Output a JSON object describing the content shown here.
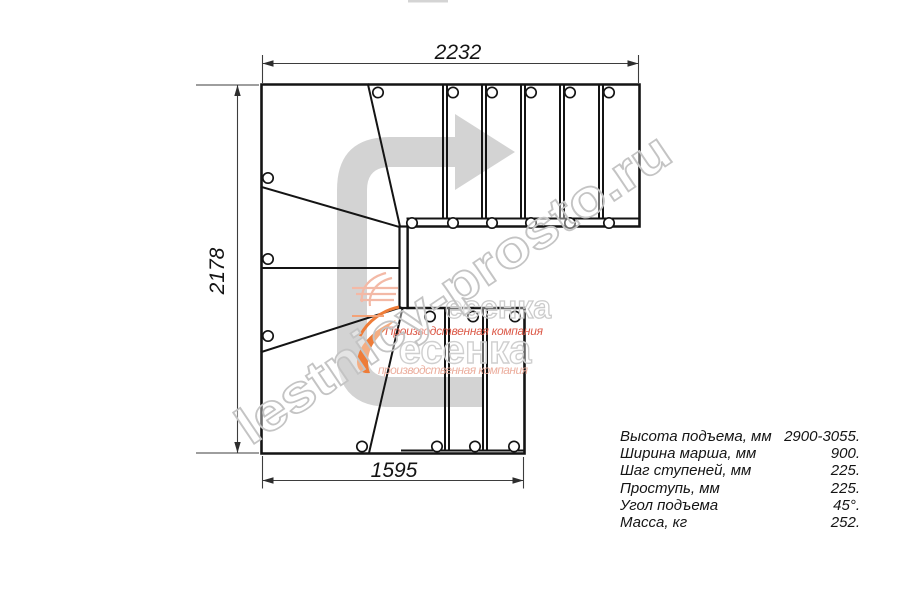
{
  "drawing_title": "Staircase plan view (U-turn, winder steps)",
  "dimensions": {
    "top": "2232",
    "left": "2178",
    "bottom": "1595"
  },
  "specs": {
    "rows": [
      {
        "label": "Высота подъема, мм",
        "value": "2900-3055."
      },
      {
        "label": "Ширина марша, мм",
        "value": "900."
      },
      {
        "label": "Шаг ступеней, мм",
        "value": "225."
      },
      {
        "label": "Проступь, мм",
        "value": "225."
      },
      {
        "label": "Угол подъема",
        "value": "45°."
      },
      {
        "label": "Масса, кг",
        "value": "252."
      }
    ]
  },
  "watermark": {
    "site": "lestnicy-prosto.ru",
    "logo": "есенка",
    "subtitle": "Производственная компания",
    "subtitle2": "производственная компания"
  },
  "colors": {
    "outline": "#141414",
    "dimension_lines": "#3d3d3d",
    "direction_arrow": "#d3d3d3",
    "watermark_gray": "#c4c4c4",
    "logo_orange": "#ee7c38",
    "logo_red": "#dc5a49",
    "logo_red_light": "#ecaf9f"
  }
}
